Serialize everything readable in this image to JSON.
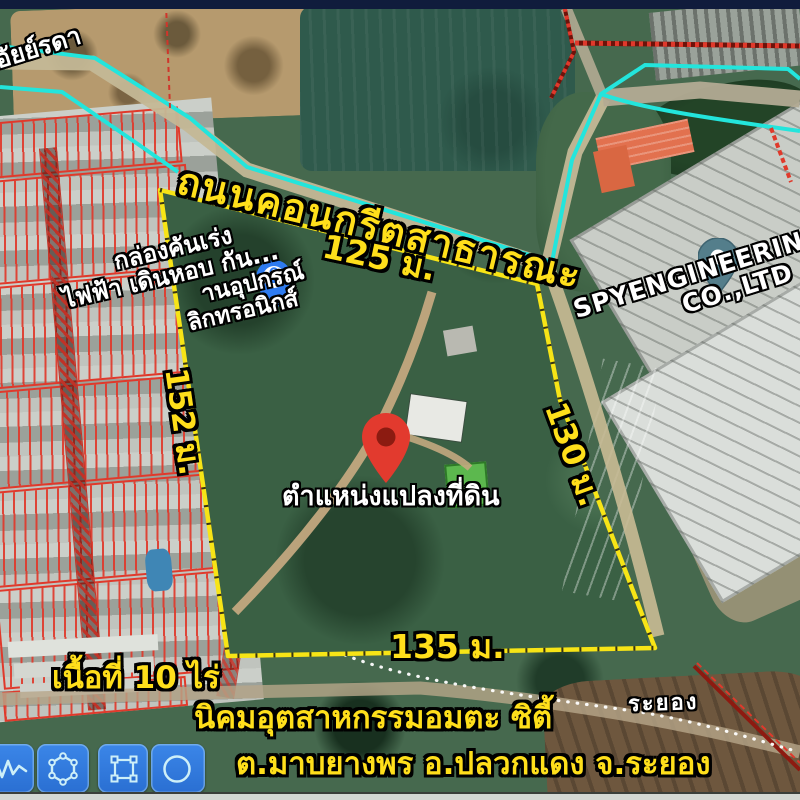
{
  "map": {
    "place_top_left": "อัยย์รดา",
    "road_label": "ถนนคอนกรีตสาธารณะ",
    "dim_top": "125 ม.",
    "dim_left": "152 ม.",
    "dim_right": "130 ม.",
    "dim_bottom": "135 ม.",
    "store_lines": [
      "กล่องคันเร่ง",
      "ไฟฟ้า เดินหอบ กัน...",
      "านอุปกรณ์",
      "ลิกทรอนิกส์"
    ],
    "pin_label": "ตำแหน่งแปลงที่ดิน",
    "company_line1": "SPYENGINEERING",
    "company_line2": "CO.,LTD",
    "province_label": "ระยอง",
    "footer": {
      "area": "เนื้อที่ 10 ไร่",
      "estate": "นิคมอุตสาหกรรมอมตะ ซิตี้",
      "address": "ต.มาบยางพร อ.ปลวกแดง จ.ระยอง"
    },
    "colors": {
      "boundary_yellow": "#f7e416",
      "road_trace_cyan": "#23e5dc",
      "parcel_red": "#e0392b",
      "label_yellow": "#ffdf1b",
      "pin_red": "#e23a2e",
      "store_pin_blue": "#2e7bf0",
      "place_pin_teal": "#547e8b",
      "toolbar_blue": "#2e7bd8"
    }
  },
  "toolbar": {
    "tools": [
      {
        "name": "freehand-draw"
      },
      {
        "name": "polygon-tool"
      },
      {
        "name": "rectangle-tool"
      },
      {
        "name": "circle-tool"
      }
    ]
  }
}
